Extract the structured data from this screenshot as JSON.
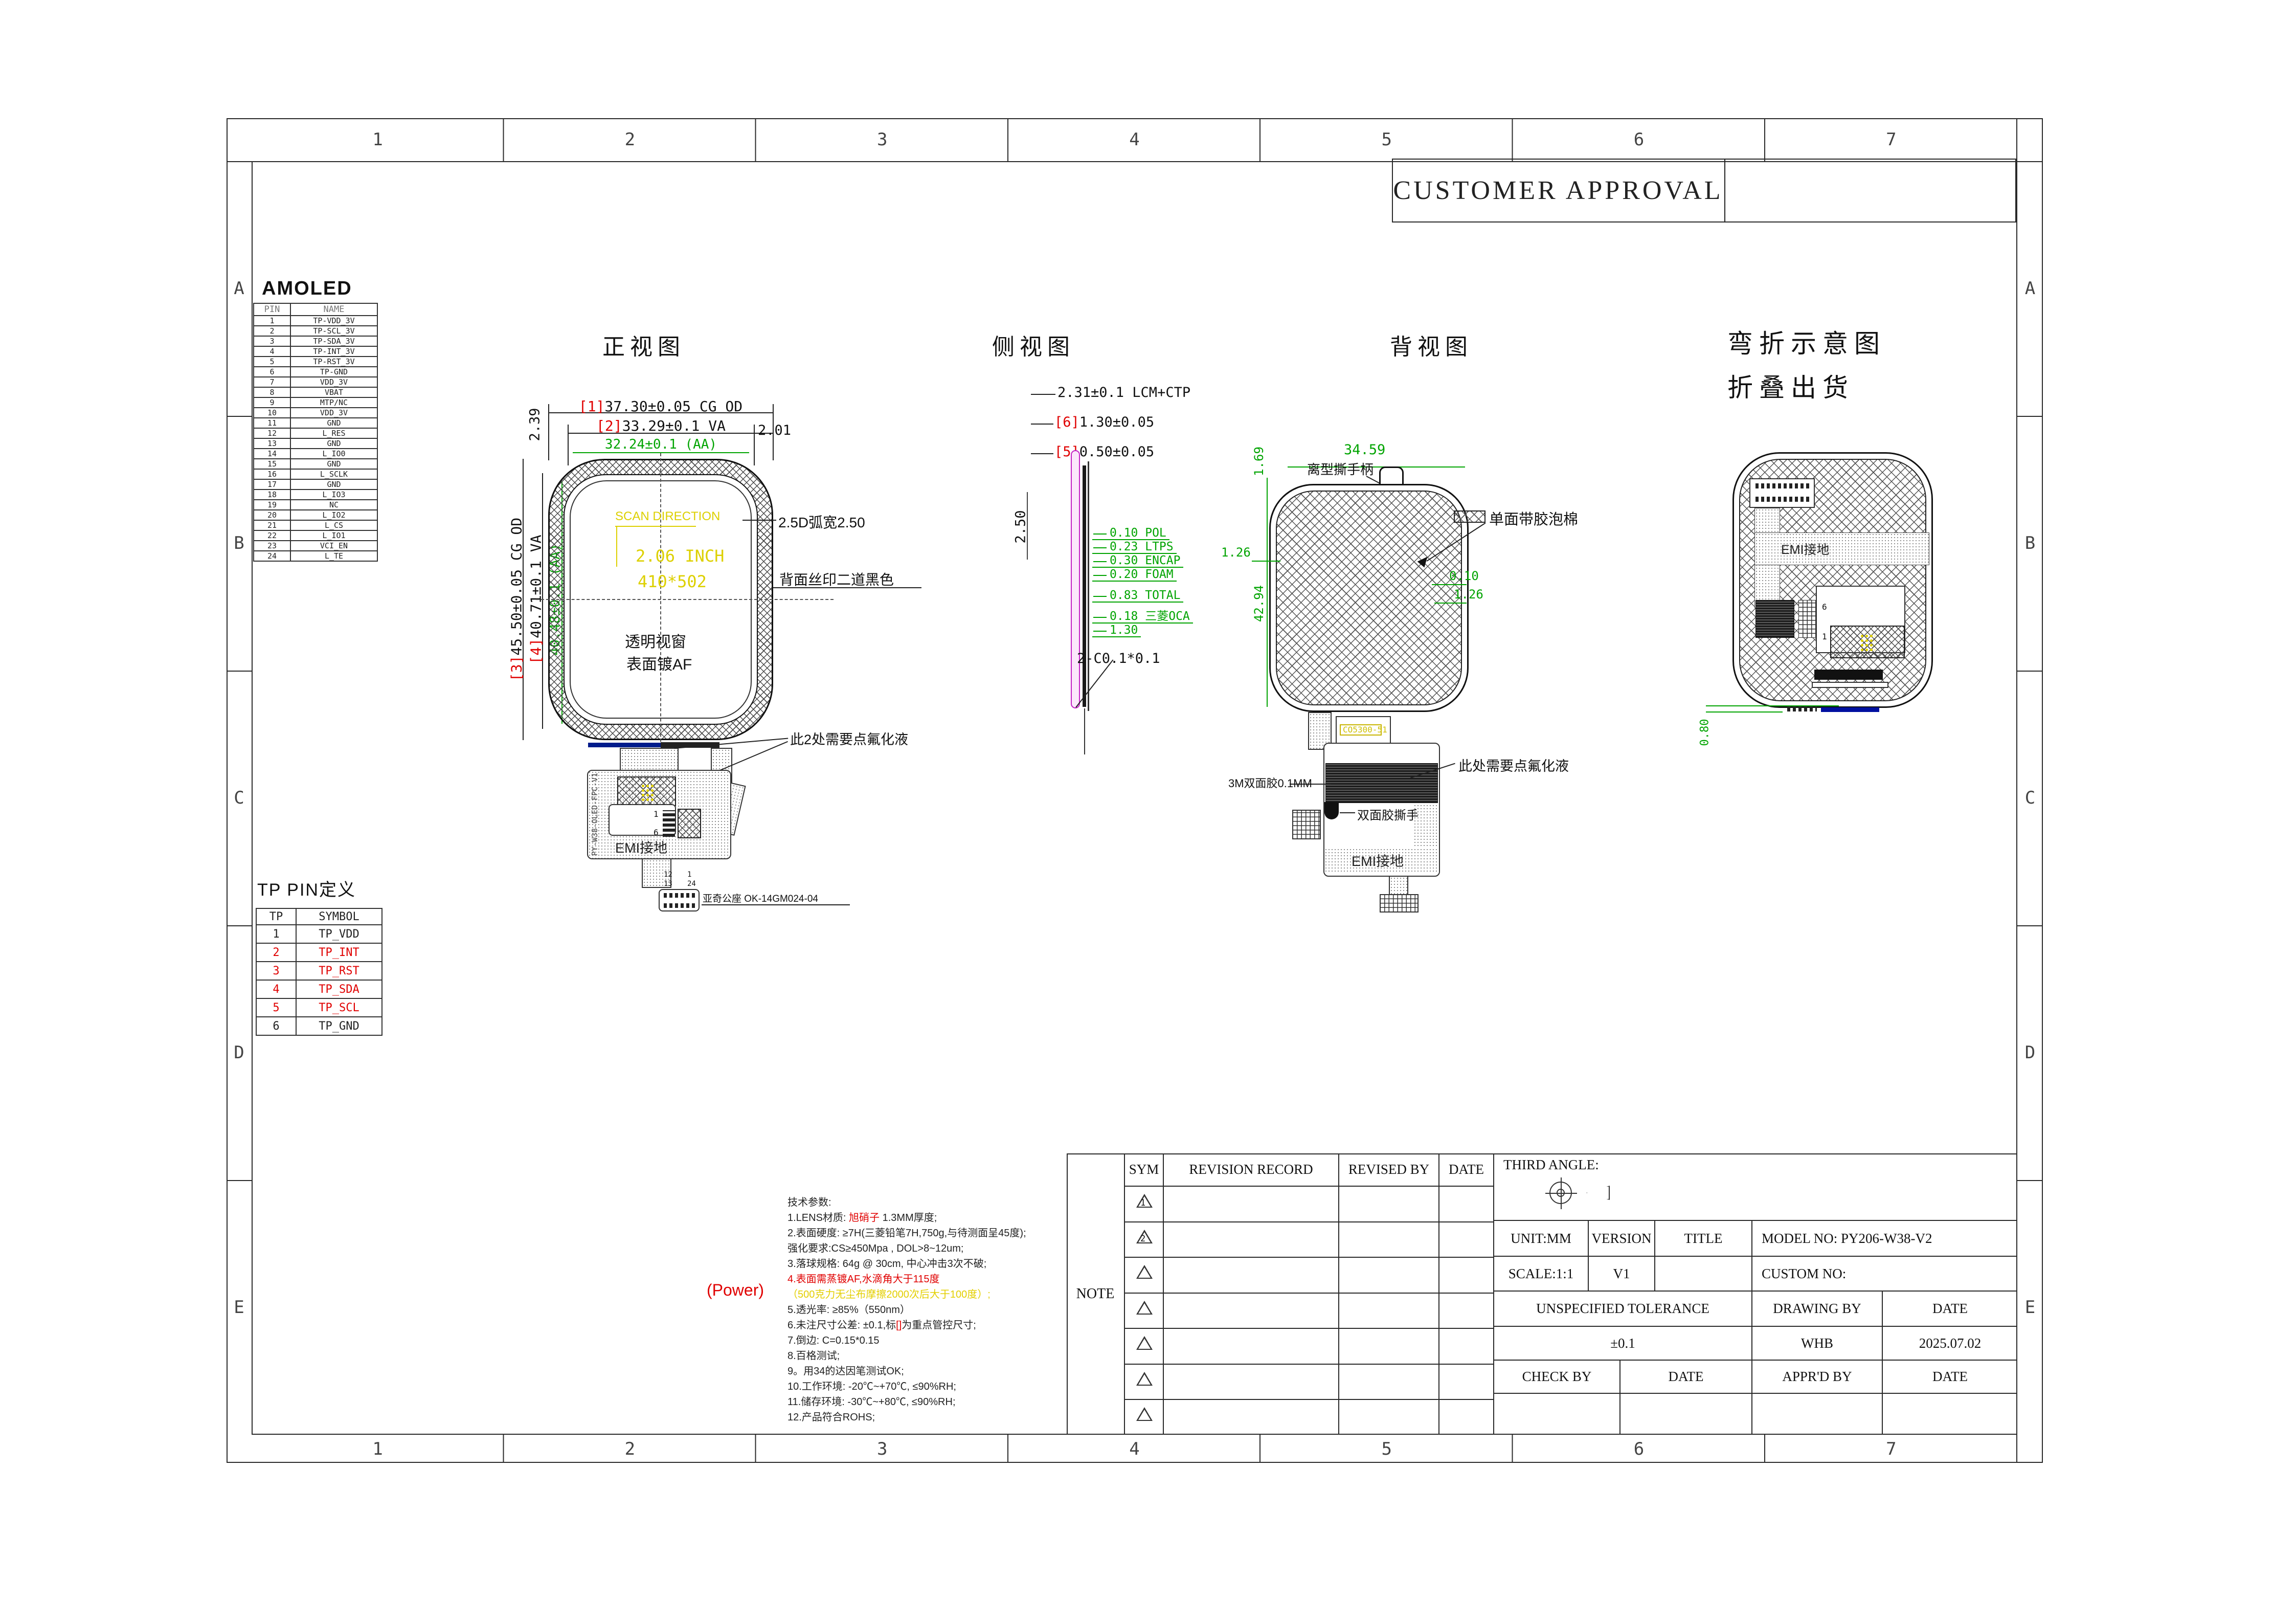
{
  "header": {
    "customer_approval": "CUSTOMER APPROVAL"
  },
  "frame": {
    "cols": [
      "1",
      "2",
      "3",
      "4",
      "5",
      "6",
      "7"
    ],
    "rows": [
      "A",
      "B",
      "C",
      "D",
      "E"
    ]
  },
  "amoled": {
    "title": "AMOLED",
    "col_pin": "PIN",
    "col_name": "NAME",
    "rows": [
      {
        "pin": "1",
        "name": "TP-VDD_3V"
      },
      {
        "pin": "2",
        "name": "TP-SCL_3V"
      },
      {
        "pin": "3",
        "name": "TP-SDA_3V"
      },
      {
        "pin": "4",
        "name": "TP-INT_3V"
      },
      {
        "pin": "5",
        "name": "TP-RST_3V"
      },
      {
        "pin": "6",
        "name": "TP-GND"
      },
      {
        "pin": "7",
        "name": "VDD_3V"
      },
      {
        "pin": "8",
        "name": "VBAT"
      },
      {
        "pin": "9",
        "name": "MTP/NC"
      },
      {
        "pin": "10",
        "name": "VDD_3V"
      },
      {
        "pin": "11",
        "name": "GND"
      },
      {
        "pin": "12",
        "name": "L_RES"
      },
      {
        "pin": "13",
        "name": "GND"
      },
      {
        "pin": "14",
        "name": "L_IO0"
      },
      {
        "pin": "15",
        "name": "GND"
      },
      {
        "pin": "16",
        "name": "L_SCLK"
      },
      {
        "pin": "17",
        "name": "GND"
      },
      {
        "pin": "18",
        "name": "L_IO3"
      },
      {
        "pin": "19",
        "name": "NC"
      },
      {
        "pin": "20",
        "name": "L_IO2"
      },
      {
        "pin": "21",
        "name": "L_CS"
      },
      {
        "pin": "22",
        "name": "L_IO1"
      },
      {
        "pin": "23",
        "name": "VCI_EN"
      },
      {
        "pin": "24",
        "name": "L_TE"
      }
    ]
  },
  "tp": {
    "title": "TP PIN定义",
    "col_tp": "TP",
    "col_symbol": "SYMBOL",
    "rows": [
      {
        "pin": "1",
        "sym": "TP_VDD"
      },
      {
        "pin": "2",
        "sym": "TP_INT",
        "c": "#e00000"
      },
      {
        "pin": "3",
        "sym": "TP_RST",
        "c": "#e00000"
      },
      {
        "pin": "4",
        "sym": "TP_SDA",
        "c": "#e00000"
      },
      {
        "pin": "5",
        "sym": "TP_SCL",
        "c": "#e00000"
      },
      {
        "pin": "6",
        "sym": "TP_GND"
      }
    ]
  },
  "front": {
    "title": "正视图",
    "d1_tag": "[1]",
    "d1": "37.30±0.05 CG OD",
    "d2_tag": "[2]",
    "d2": "33.29±0.1 VA",
    "d_aa_w": "32.24±0.1 (AA)",
    "d_right": "2.01",
    "d_left_top": "2.39",
    "d3_tag": "[3]",
    "d3": "45.50±0.05 CG OD",
    "d4_tag": "[4]",
    "d4": "40.71±0.1 VA",
    "d_aa_h": "40.48±0.1 (AA)",
    "scan": "SCAN DIRECTION",
    "inch": "2.06 INCH",
    "res": "410*502",
    "arc": "2.5D弧宽2.50",
    "silk": "背面丝印二道黑色",
    "win1": "透明视窗",
    "win2": "表面镀AF",
    "fluoride": "此2处需要点氟化液",
    "emi": "EMI接地",
    "fpc_label": "PY-W38-OLED-FPC-V1",
    "conn_note": "亚奇公座 OK-14GM024-04",
    "pin1": "1",
    "pin6": "6",
    "pin12": "12",
    "pin1b": "1",
    "pin13": "13",
    "pin24": "24"
  },
  "side": {
    "title": "侧视图",
    "d_total": "2.31±0.1 LCM+CTP",
    "d6_tag": "[6]",
    "d6": "1.30±0.05",
    "d5_tag": "[5]",
    "d5": "0.50±0.05",
    "d_250": "2.50",
    "chamfer": "2-C0.1*0.1",
    "layers": [
      {
        "t": "0.10 POL"
      },
      {
        "t": "0.23 LTPS"
      },
      {
        "t": "0.30 ENCAP"
      },
      {
        "t": "0.20 FOAM"
      },
      {
        "t": "0.83 TOTAL"
      },
      {
        "t": "0.18 三菱OCA"
      },
      {
        "t": "1.30"
      }
    ]
  },
  "back": {
    "title": "背视图",
    "d_3459": "34.59",
    "handle": "离型撕手柄",
    "legend": "单面带胶泡棉",
    "d_010": "0.10",
    "d_126r": "1.26",
    "d_169": "1.69",
    "d_126l": "1.26",
    "d_4294": "42.94",
    "fluoride": "此处需要点氟化液",
    "tape": "3M双面胶0.1MM",
    "tape_pull": "双面胶撕手",
    "emi": "EMI接地",
    "ic_label": "CO5300-51"
  },
  "bend": {
    "title1": "弯折示意图",
    "title2": "折叠出货",
    "d_080": "0.80",
    "emi": "EMI接地",
    "pin6": "6",
    "pin1": "1"
  },
  "notes": {
    "power": "(Power)",
    "title": "技术参数:",
    "lines": [
      {
        "pre": "1.LENS材质: ",
        "red": "旭硝子",
        "post": " 1.3MM厚度;"
      },
      {
        "pre": "2.表面硬度: ≥7H(三菱铅笔7H,750g,与待测面呈45度);"
      },
      {
        "pre": "   强化要求:CS≥450Mpa , DOL>8~12um;"
      },
      {
        "pre": "3.落球规格: 64g @ 30cm, 中心冲击3次不破;"
      },
      {
        "pre": "4.表面需蒸镀AF,水滴角大于115度",
        "c": "#e00000"
      },
      {
        "pre": "（500克力无尘布摩擦2000次后大于100度）;",
        "c": "#e3cf00"
      },
      {
        "pre": "5.透光率: ≥85%（550nm）"
      },
      {
        "pre": "6.未注尺寸公差: ±0.1,标",
        "red": "[]",
        "post": "为重点管控尺寸;"
      },
      {
        "pre": "7.倒边: C=0.15*0.15"
      },
      {
        "pre": "8.百格测试;"
      },
      {
        "pre": "9。用34的达因笔测试OK;"
      },
      {
        "pre": "10.工作环境: -20℃~+70℃, ≤90%RH;"
      },
      {
        "pre": "11.储存环境: -30℃~+80℃, ≤90%RH;"
      },
      {
        "pre": "12.产品符合ROHS;"
      }
    ]
  },
  "revision": {
    "note": "NOTE",
    "sym": "SYM",
    "record": "REVISION RECORD",
    "revised": "REVISED BY",
    "date": "DATE",
    "third": "THIRD ANGLE:",
    "rows": [
      {
        "n": "1"
      },
      {
        "n": "2"
      },
      {
        "n": ""
      },
      {
        "n": ""
      },
      {
        "n": ""
      },
      {
        "n": ""
      },
      {
        "n": ""
      }
    ]
  },
  "titleblock": {
    "unit": "UNIT:MM",
    "version": "VERSION",
    "title": "TITLE",
    "model": "MODEL  NO:  PY206-W38-V2",
    "scale": "SCALE:1:1",
    "v1": "V1",
    "custom": "CUSTOM NO:",
    "unspec": "UNSPECIFIED TOLERANCE",
    "drawing_by": "DRAWING BY",
    "date1": "DATE",
    "tol": "±0.1",
    "whb": "WHB",
    "date_val": "2025.07.02",
    "check": "CHECK BY",
    "date2": "DATE",
    "appr": "APPR'D BY",
    "date3": "DATE"
  }
}
